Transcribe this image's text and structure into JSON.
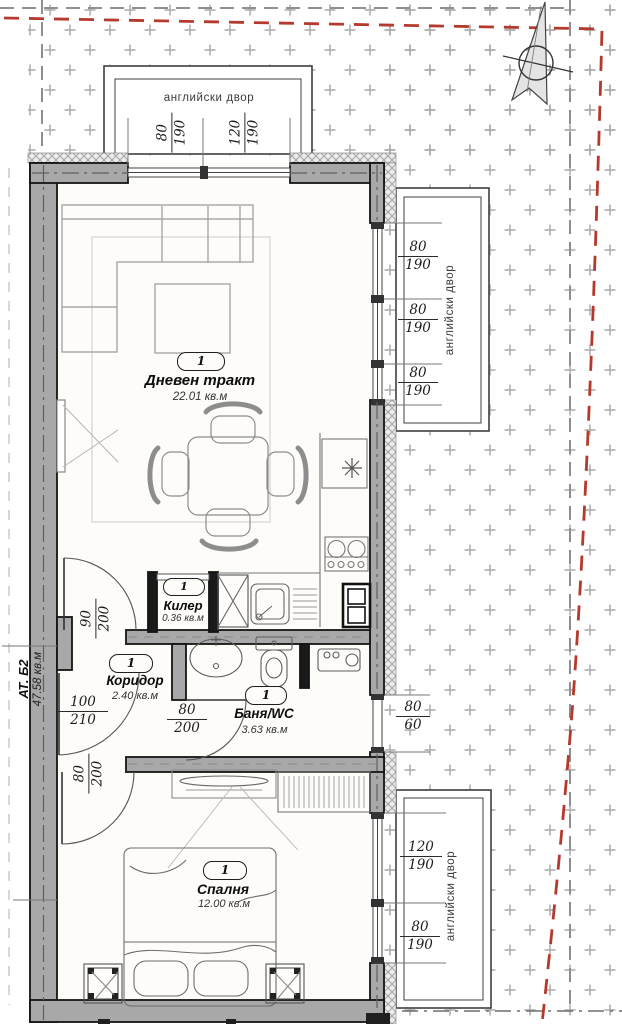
{
  "plan_meta": {
    "apartment_code": "АТ. Б2",
    "apartment_area": "47.58 кв.м"
  },
  "courtyards": {
    "top_label": "английски двор",
    "right_upper_label": "английски двор",
    "right_lower_label": "английски двор"
  },
  "rooms": [
    {
      "number": "1",
      "name": "Дневен тракт",
      "area": "22.01 кв.м"
    },
    {
      "number": "1",
      "name": "Килер",
      "area": "0.36 кв.м"
    },
    {
      "number": "1",
      "name": "Коридор",
      "area": "2.40 кв.м"
    },
    {
      "number": "1",
      "name": "Баня/WC",
      "area": "3.63 кв.м"
    },
    {
      "number": "1",
      "name": "Спалня",
      "area": "12.00 кв.м"
    }
  ],
  "dimensions": [
    {
      "id": "top-window-left",
      "num": "80",
      "den": "190"
    },
    {
      "id": "top-window-right",
      "num": "120",
      "den": "190"
    },
    {
      "id": "living-window-1",
      "num": "80",
      "den": "190"
    },
    {
      "id": "living-window-2",
      "num": "80",
      "den": "190"
    },
    {
      "id": "living-window-3",
      "num": "80",
      "den": "190"
    },
    {
      "id": "bath-window",
      "num": "80",
      "den": "60"
    },
    {
      "id": "bedroom-window-1",
      "num": "120",
      "den": "190"
    },
    {
      "id": "bedroom-window-2",
      "num": "80",
      "den": "190"
    },
    {
      "id": "door-corridor-living",
      "num": "90",
      "den": "200"
    },
    {
      "id": "door-entry",
      "num": "100",
      "den": "210"
    },
    {
      "id": "door-bath",
      "num": "80",
      "den": "200"
    },
    {
      "id": "door-bedroom",
      "num": "80",
      "den": "200"
    }
  ],
  "colors": {
    "wall_fill": "#a8a8a8",
    "outline": "#141414",
    "courtyard_plus": "#ababab",
    "boundary_red": "#b43a2e",
    "boundary_gray": "#8f8f8f",
    "floor": "#fdfcf8"
  }
}
